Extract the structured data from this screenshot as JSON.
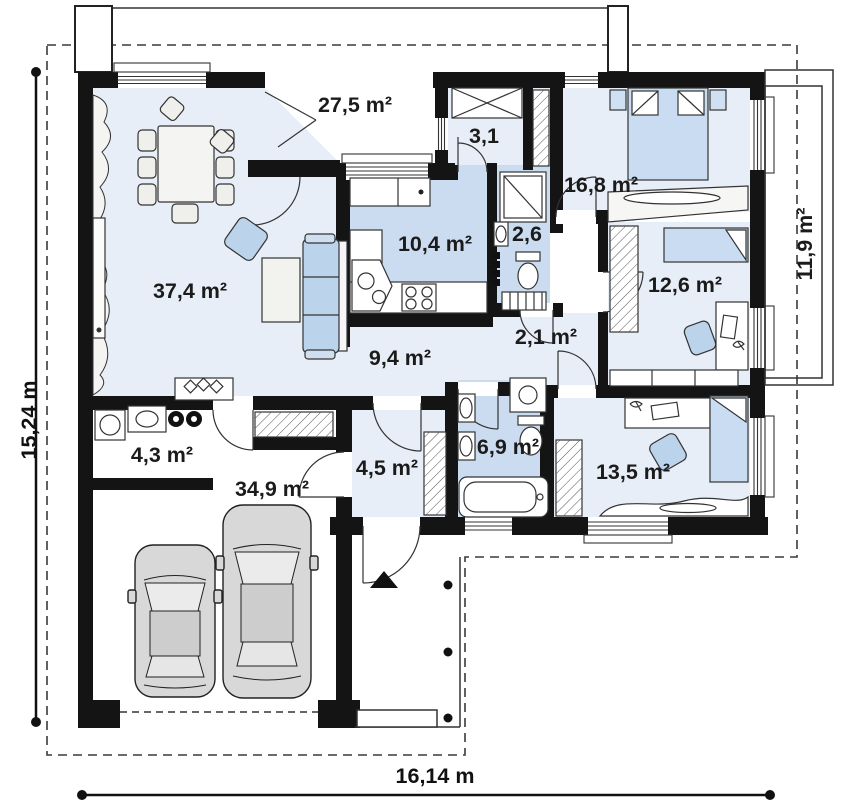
{
  "plan": {
    "rooms": [
      {
        "id": "terrace-top",
        "label": "27,5 m²"
      },
      {
        "id": "pantry",
        "label": "3,1"
      },
      {
        "id": "bedroom-main",
        "label": "16,8 m²"
      },
      {
        "id": "wc",
        "label": "2,6"
      },
      {
        "id": "kitchen",
        "label": "10,4 m²"
      },
      {
        "id": "living-room",
        "label": "37,4 m²"
      },
      {
        "id": "bedroom-right",
        "label": "12,6 m²"
      },
      {
        "id": "terrace-right",
        "label": "11,9 m²"
      },
      {
        "id": "corridor",
        "label": "2,1 m²"
      },
      {
        "id": "hall",
        "label": "9,4 m²"
      },
      {
        "id": "laundry",
        "label": "4,3 m²"
      },
      {
        "id": "bathroom",
        "label": "6,9 m²"
      },
      {
        "id": "entry",
        "label": "4,5 m²"
      },
      {
        "id": "garage",
        "label": "34,9 m²"
      },
      {
        "id": "bedroom-bottom",
        "label": "13,5 m²"
      }
    ],
    "dimensions": {
      "height_label": "15,24 m",
      "width_label": "16,14 m"
    },
    "colors": {
      "wall": "#141414",
      "floor_light": "#e8eef7",
      "floor_blue": "#cbdcf1",
      "furniture_blue": "#bcd3ec",
      "bed_blue": "#c9dcf1",
      "car_gray": "#d8d8d8"
    }
  }
}
